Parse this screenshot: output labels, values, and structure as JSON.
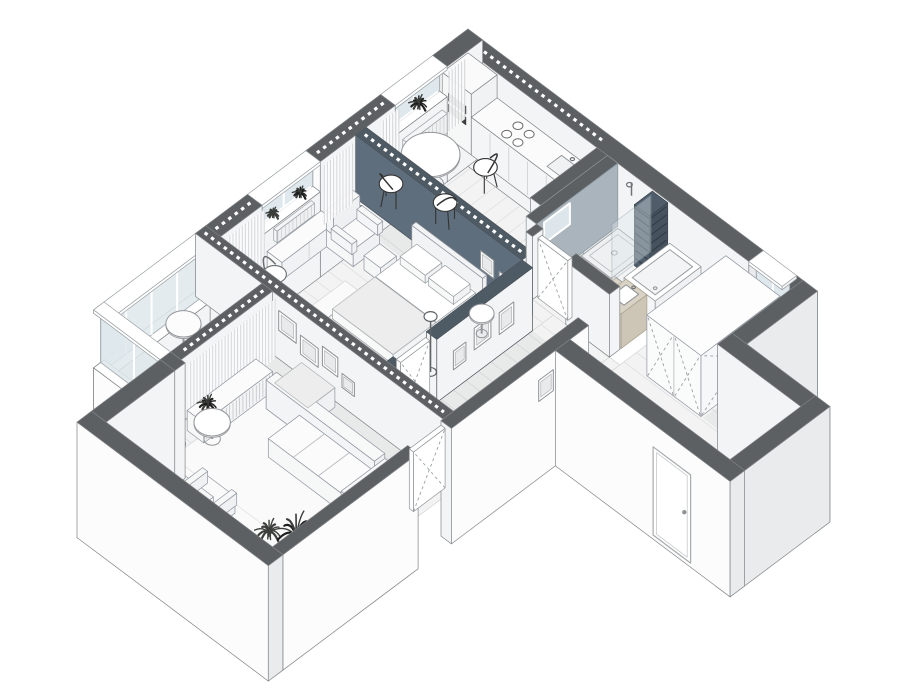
{
  "scene": {
    "description": "Isometric cutaway floor plan rendering of an apartment",
    "rooms": [
      "kitchen",
      "bedroom",
      "living-room",
      "balcony",
      "bathroom",
      "corridor",
      "entrance-hall"
    ],
    "furniture": [
      "kitchen-counter",
      "fridge-oven-column",
      "cooktop",
      "dining-table",
      "dining-chairs",
      "radiator",
      "bed",
      "pillows",
      "headboard",
      "bedroom-armchair",
      "side-table",
      "floor-lamp",
      "dresser",
      "sofa",
      "chaise",
      "coffee-table",
      "tv-console",
      "living-armchair",
      "stool",
      "wardrobe",
      "shower",
      "glass-partition",
      "shelf-unit",
      "bathtub",
      "vanity-basin",
      "toilet",
      "front-door",
      "door-leaves",
      "windows",
      "curtains",
      "plants",
      "picture-frames",
      "rugs"
    ]
  },
  "projection": {
    "s": 52,
    "kx": 0.8,
    "ky": 0.6,
    "hs": 42,
    "ox": 468,
    "oy": 92
  },
  "colors": {
    "background": "#ffffff",
    "wall_top": "#5d6062",
    "wall_top_accent": "#4e5a64",
    "wall_frame_white": "#ffffff",
    "ext_face_sw": "#fcfcfd",
    "ext_face_se": "#e9ebec",
    "int_face": "#f3f4f5",
    "accent_wall": "#5f6e7c",
    "bath_wall": "#aab4bc",
    "slat_unit": "#4f5d6b",
    "floor": "#f3f3f3",
    "plank_line": "#dfe0e1",
    "bath_floor": "#f1f2f2",
    "balcony_floor": "#ededee",
    "rug": "#fafafa",
    "rug_line": "#e3e3e3",
    "furniture": "#f8f8f8",
    "furniture_line": "#94969a",
    "wood": "#d9d3c5",
    "glass": "#dfe8ec",
    "plant_dark": "#1d1e1d",
    "plant_mid": "#3b3e3b",
    "wire": "#333333",
    "outline": "#808487",
    "shadow": "rgba(40,50,60,0.05)",
    "dark_slot": "#3d4043"
  }
}
